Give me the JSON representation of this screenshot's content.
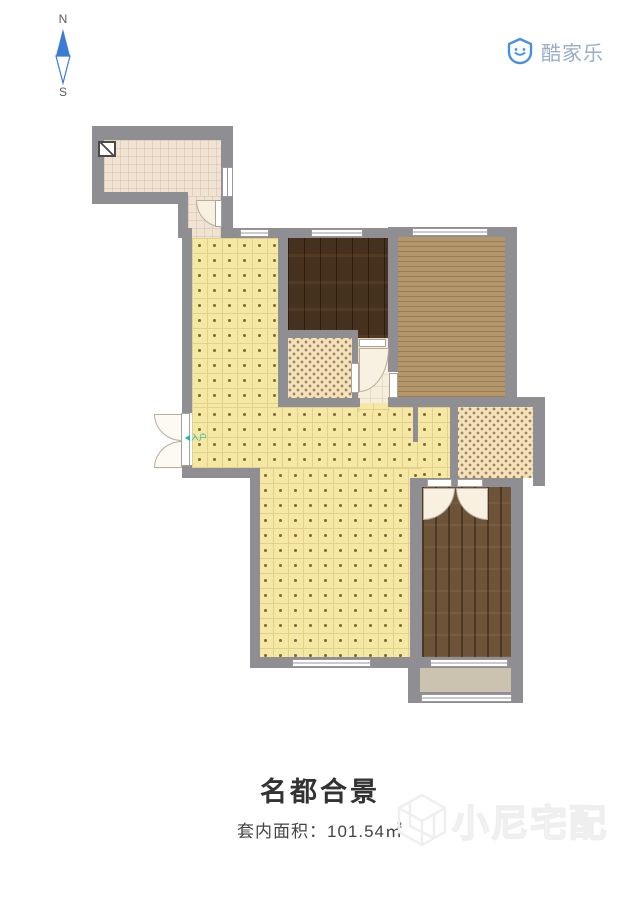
{
  "compass": {
    "north": "N",
    "south": "S"
  },
  "logo": {
    "brand": "酷家乐"
  },
  "plan": {
    "entry_label": "入户"
  },
  "footer": {
    "title": "名都合景",
    "area_text": "套内面积：101.54㎡"
  },
  "watermark": {
    "text": "小尼宅配"
  },
  "colors": {
    "wall": "#8e8e93",
    "living_tile": "#f5e7a4",
    "storage_floor": "#f0e3d3",
    "bedroom_dark_wood": "#46311f",
    "bedroom_tan_wood": "#b3966a",
    "bedroom_plank_wood": "#6d5338",
    "wet_room_tile": "#f3e2c0",
    "balcony_floor": "#cbc2b0",
    "compass_blue": "#3a7bd5",
    "logo_blue": "#4a90e2",
    "logo_text": "#9cadc6",
    "entry_marker_teal": "#1fb3ad",
    "title_text": "#333333",
    "watermark_gray": "#efefef"
  }
}
